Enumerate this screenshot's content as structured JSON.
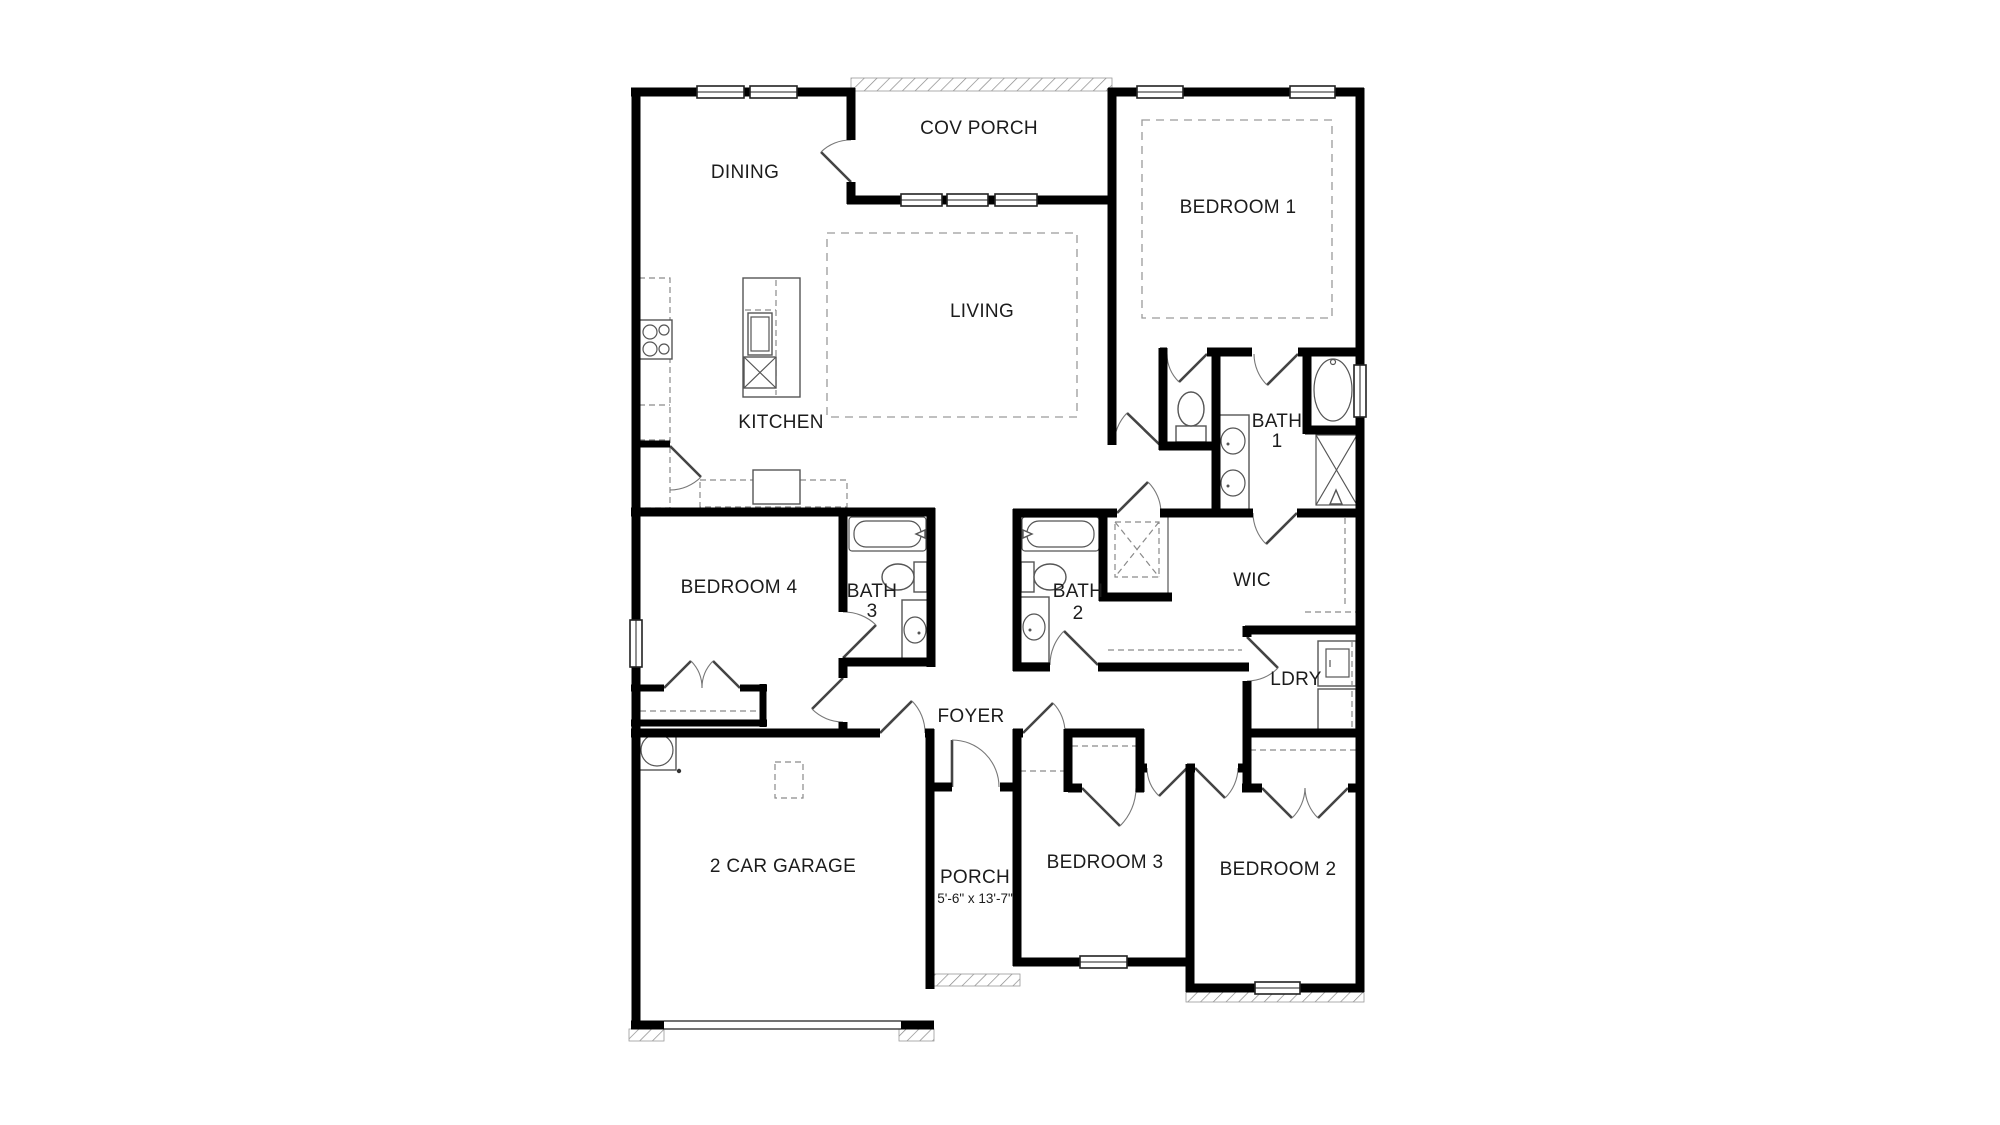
{
  "floor_plan": {
    "background_color": "#ffffff",
    "wall_color": "#000000",
    "rooms": [
      {
        "name": "dining",
        "label": "DINING"
      },
      {
        "name": "cov_porch",
        "label": "COV PORCH"
      },
      {
        "name": "bedroom_1",
        "label": "BEDROOM 1"
      },
      {
        "name": "living",
        "label": "LIVING"
      },
      {
        "name": "kitchen",
        "label": "KITCHEN"
      },
      {
        "name": "bath_1",
        "line1": "BATH",
        "line2": "1"
      },
      {
        "name": "bedroom_4",
        "label": "BEDROOM 4"
      },
      {
        "name": "bath_3",
        "line1": "BATH",
        "line2": "3"
      },
      {
        "name": "bath_2",
        "line1": "BATH",
        "line2": "2"
      },
      {
        "name": "wic",
        "label": "WIC"
      },
      {
        "name": "ldry",
        "label": "LDRY"
      },
      {
        "name": "foyer",
        "label": "FOYER"
      },
      {
        "name": "porch",
        "label": "PORCH",
        "dimensions": "5'-6\" x 13'-7\""
      },
      {
        "name": "bedroom_3",
        "label": "BEDROOM 3"
      },
      {
        "name": "bedroom_2",
        "label": "BEDROOM 2"
      },
      {
        "name": "garage",
        "label": "2 CAR GARAGE"
      }
    ]
  }
}
